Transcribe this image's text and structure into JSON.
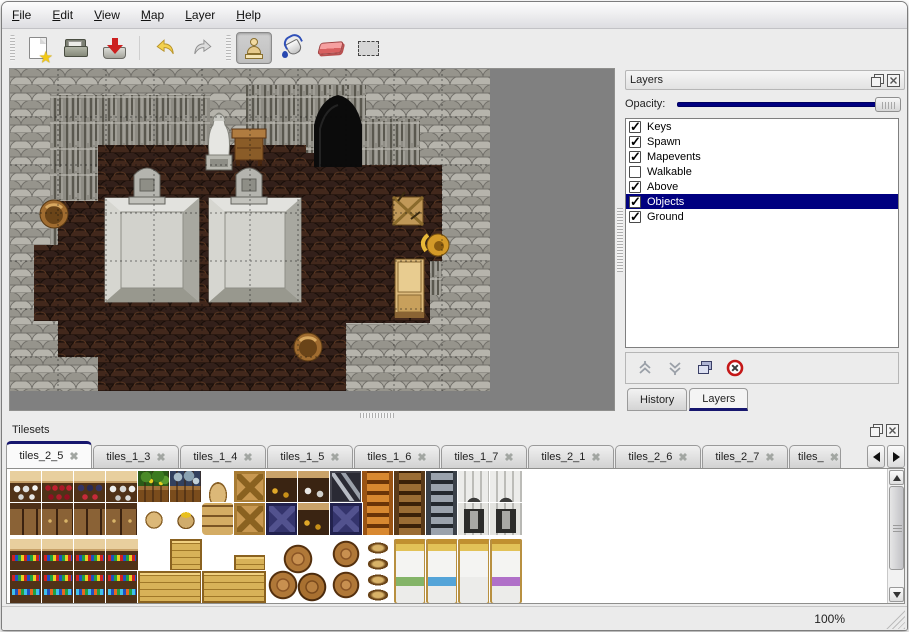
{
  "colors": {
    "accent": "#000080",
    "selection_bg": "#000080",
    "selection_text": "#ffffff",
    "map_backdrop": "#808080",
    "window_bg": "#ececec"
  },
  "menu": {
    "items": [
      "File",
      "Edit",
      "View",
      "Map",
      "Layer",
      "Help"
    ]
  },
  "toolbar": {
    "items": [
      {
        "type": "grip"
      },
      {
        "type": "button",
        "tool": "new"
      },
      {
        "type": "button",
        "tool": "open"
      },
      {
        "type": "button",
        "tool": "save"
      },
      {
        "type": "sep"
      },
      {
        "type": "button",
        "tool": "undo"
      },
      {
        "type": "button",
        "tool": "redo"
      },
      {
        "type": "grip"
      },
      {
        "type": "button",
        "tool": "stamp",
        "selected": true
      },
      {
        "type": "button",
        "tool": "fill"
      },
      {
        "type": "button",
        "tool": "eraser"
      },
      {
        "type": "button",
        "tool": "select"
      }
    ]
  },
  "map_view": {
    "objects": [
      "stone-wall",
      "cliff",
      "floor",
      "cave-entrance",
      "statue",
      "side-table",
      "gravestone",
      "platform",
      "broken-crate",
      "golden-horn",
      "cabinet",
      "basket"
    ]
  },
  "layers_panel": {
    "title": "Layers",
    "opacity_label": "Opacity:",
    "layers": [
      {
        "name": "Keys",
        "checked": true,
        "selected": false
      },
      {
        "name": "Spawn",
        "checked": true,
        "selected": false
      },
      {
        "name": "Mapevents",
        "checked": true,
        "selected": false
      },
      {
        "name": "Walkable",
        "checked": false,
        "selected": false
      },
      {
        "name": "Above",
        "checked": true,
        "selected": false
      },
      {
        "name": "Objects",
        "checked": true,
        "selected": true
      },
      {
        "name": "Ground",
        "checked": true,
        "selected": false
      }
    ],
    "buttons": [
      "raise-layer",
      "lower-layer",
      "duplicate-layer",
      "delete-layer"
    ],
    "tabs": [
      {
        "label": "History",
        "active": false
      },
      {
        "label": "Layers",
        "active": true
      }
    ]
  },
  "tilesets_panel": {
    "title": "Tilesets",
    "tabs": [
      {
        "label": "tiles_2_5",
        "active": true
      },
      {
        "label": "tiles_1_3",
        "active": false
      },
      {
        "label": "tiles_1_4",
        "active": false
      },
      {
        "label": "tiles_1_5",
        "active": false
      },
      {
        "label": "tiles_1_6",
        "active": false
      },
      {
        "label": "tiles_1_7",
        "active": false
      },
      {
        "label": "tiles_2_1",
        "active": false
      },
      {
        "label": "tiles_2_6",
        "active": false
      },
      {
        "label": "tiles_2_7",
        "active": false
      },
      {
        "label": "tiles_",
        "active": false,
        "partial": true
      }
    ],
    "tiles": [
      [
        0,
        0,
        32,
        32,
        "shelf-dishes"
      ],
      [
        32,
        0,
        32,
        32,
        "shelf-wine"
      ],
      [
        64,
        0,
        32,
        32,
        "shelf-dark"
      ],
      [
        96,
        0,
        32,
        32,
        "shelf-jars"
      ],
      [
        128,
        0,
        32,
        32,
        "plant-crate"
      ],
      [
        160,
        0,
        32,
        32,
        "fish-crate"
      ],
      [
        192,
        0,
        32,
        32,
        "sack-top"
      ],
      [
        224,
        0,
        32,
        32,
        "crate-x"
      ],
      [
        256,
        0,
        32,
        32,
        "counter-gold"
      ],
      [
        288,
        0,
        32,
        32,
        "counter-dish"
      ],
      [
        320,
        0,
        32,
        32,
        "sign-z4"
      ],
      [
        352,
        0,
        32,
        64,
        "ladder-orange"
      ],
      [
        384,
        0,
        32,
        64,
        "ladder-brown"
      ],
      [
        416,
        0,
        32,
        64,
        "ladder-gray"
      ],
      [
        448,
        0,
        32,
        32,
        "arch-top"
      ],
      [
        480,
        0,
        32,
        32,
        "arch-top"
      ],
      [
        0,
        32,
        32,
        32,
        "shelf-drawer"
      ],
      [
        32,
        32,
        32,
        32,
        "shelf-drawer2"
      ],
      [
        64,
        32,
        32,
        32,
        "shelf-drawer"
      ],
      [
        96,
        32,
        32,
        32,
        "shelf-drawer2"
      ],
      [
        128,
        32,
        32,
        32,
        "sack-big"
      ],
      [
        160,
        32,
        32,
        32,
        "sack-open"
      ],
      [
        192,
        32,
        32,
        32,
        "sack-pile"
      ],
      [
        224,
        32,
        32,
        32,
        "crate-x"
      ],
      [
        256,
        32,
        32,
        32,
        "crate-navy"
      ],
      [
        288,
        32,
        32,
        32,
        "counter-gold"
      ],
      [
        320,
        32,
        32,
        32,
        "crate-navy"
      ],
      [
        448,
        32,
        32,
        32,
        "arch-door"
      ],
      [
        480,
        32,
        32,
        32,
        "arch-door"
      ],
      [
        0,
        68,
        32,
        32,
        "shelf-goods-top"
      ],
      [
        32,
        68,
        32,
        32,
        "shelf-goods-top"
      ],
      [
        64,
        68,
        32,
        32,
        "shelf-goods-top"
      ],
      [
        96,
        68,
        32,
        32,
        "shelf-goods-top"
      ],
      [
        160,
        68,
        32,
        32,
        "crate-lid"
      ],
      [
        224,
        84,
        32,
        16,
        "crate-half"
      ],
      [
        256,
        68,
        64,
        64,
        "barrel-pile"
      ],
      [
        320,
        68,
        32,
        64,
        "barrel-two"
      ],
      [
        352,
        68,
        32,
        64,
        "pot-stack"
      ],
      [
        384,
        68,
        32,
        64,
        "bed-green"
      ],
      [
        416,
        68,
        32,
        64,
        "bed-blue"
      ],
      [
        448,
        68,
        32,
        64,
        "bed-white"
      ],
      [
        480,
        68,
        32,
        64,
        "bed-purple"
      ],
      [
        0,
        100,
        32,
        32,
        "shelf-goods-bot"
      ],
      [
        32,
        100,
        32,
        32,
        "shelf-goods-bot"
      ],
      [
        64,
        100,
        32,
        32,
        "shelf-goods-bot"
      ],
      [
        96,
        100,
        32,
        32,
        "shelf-goods-bot"
      ],
      [
        128,
        100,
        64,
        32,
        "crate-wide"
      ],
      [
        192,
        100,
        64,
        32,
        "crate-wide"
      ]
    ]
  },
  "statusbar": {
    "zoom_level": "100%"
  }
}
